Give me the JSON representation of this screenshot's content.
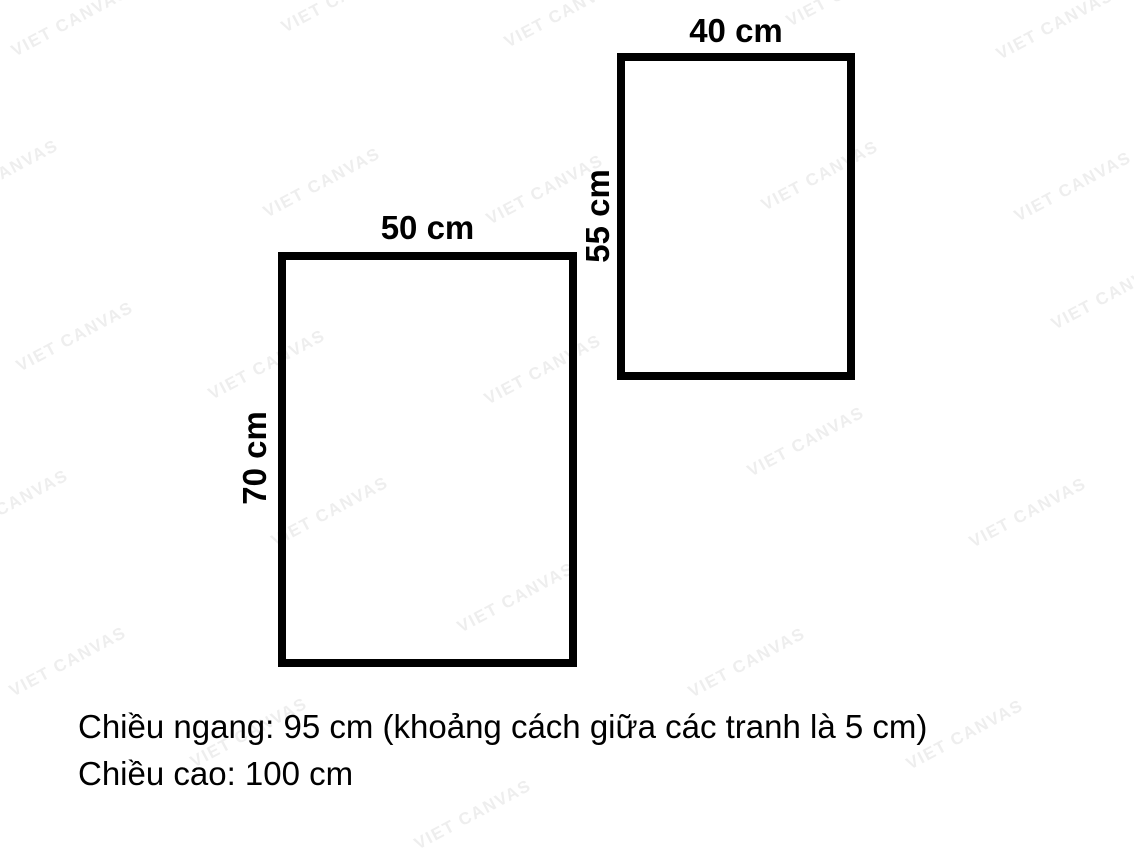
{
  "watermark": {
    "text": "VIET CANVAS",
    "color": "#eeeeee",
    "rotation_deg": -28,
    "positions": [
      [
        70,
        22
      ],
      [
        340,
        -2
      ],
      [
        563,
        13
      ],
      [
        845,
        -8
      ],
      [
        1055,
        25
      ],
      [
        0,
        175
      ],
      [
        322,
        183
      ],
      [
        545,
        190
      ],
      [
        820,
        176
      ],
      [
        1073,
        187
      ],
      [
        75,
        337
      ],
      [
        267,
        365
      ],
      [
        543,
        370
      ],
      [
        806,
        442
      ],
      [
        1110,
        295
      ],
      [
        10,
        505
      ],
      [
        330,
        512
      ],
      [
        1028,
        513
      ],
      [
        516,
        598
      ],
      [
        68,
        662
      ],
      [
        747,
        663
      ],
      [
        249,
        733
      ],
      [
        965,
        735
      ],
      [
        473,
        815
      ]
    ]
  },
  "diagram": {
    "panels": [
      {
        "name": "right-panel",
        "width_label": "40 cm",
        "height_label": "55 cm"
      },
      {
        "name": "left-panel",
        "width_label": "50 cm",
        "height_label": "70 cm"
      }
    ],
    "outline_color": "#000000"
  },
  "summary": {
    "line1": "Chiều ngang: 95 cm (khoảng cách giữa các tranh là 5 cm)",
    "line2": "Chiều cao: 100 cm"
  }
}
